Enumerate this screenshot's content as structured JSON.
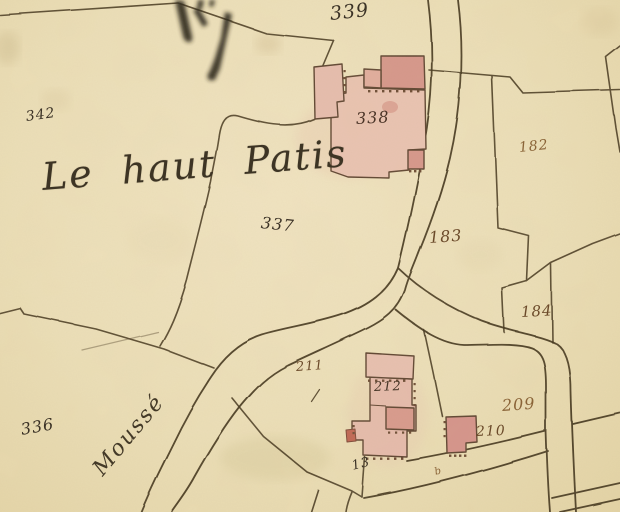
{
  "map_type": "cadastral-map",
  "lieu_dit_label": "Le haut Patis",
  "road_label": "Moussé",
  "survey_mark_label": "b",
  "parcels": [
    {
      "number": "342"
    },
    {
      "number": "339"
    },
    {
      "number": "338"
    },
    {
      "number": "337"
    },
    {
      "number": "336"
    },
    {
      "number": "182"
    },
    {
      "number": "183"
    },
    {
      "number": "184"
    },
    {
      "number": "209"
    },
    {
      "number": "210"
    },
    {
      "number": "211"
    },
    {
      "number": "212"
    },
    {
      "number": "13"
    }
  ],
  "colors": {
    "paper": "#ecdfb8",
    "boundary_ink": "#4a3a23",
    "dark_ink": "#3b3226",
    "label_brown": "#8a6438",
    "building_pink": "#e6bbac",
    "building_dark_pink": "#d6968a"
  }
}
